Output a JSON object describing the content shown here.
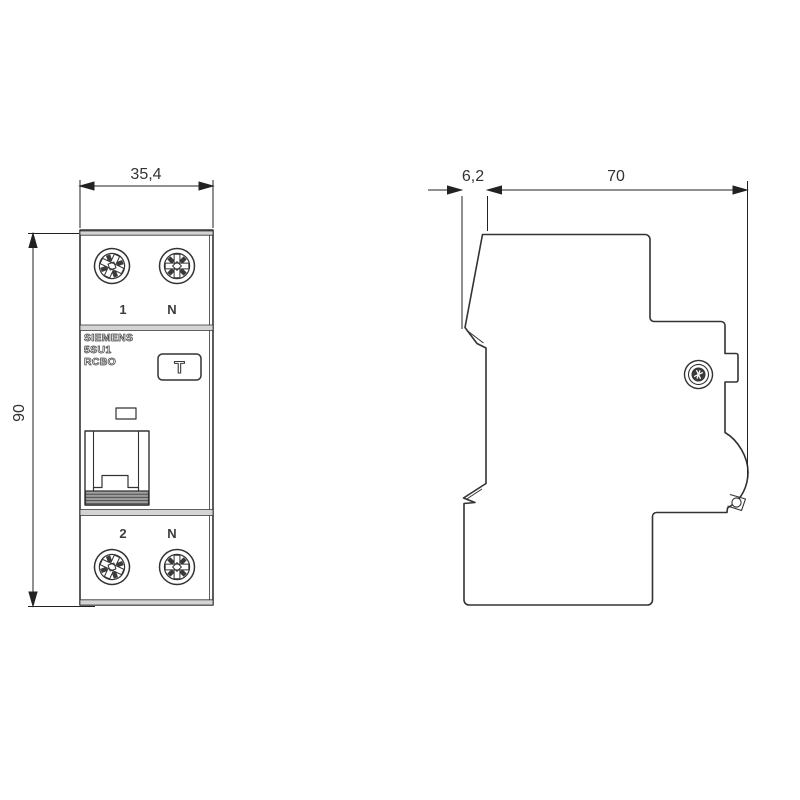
{
  "drawing": {
    "title": "circuit-breaker-dimension-drawing",
    "dimensions": {
      "front_width_mm": "35,4",
      "front_height_mm": "90",
      "side_front_depth_mm": "6,2",
      "side_depth_mm": "70"
    },
    "front": {
      "terminals_top": [
        "1",
        "N"
      ],
      "terminals_bottom": [
        "2",
        "N"
      ],
      "product_lines": [
        "SIEMENS",
        "5SU1",
        "RCBO"
      ],
      "test_button_label": "T"
    },
    "colors": {
      "line": "#333333",
      "band_fill": "#d4d4d4",
      "grip_fill": "#9e9e9e",
      "background": "#ffffff"
    }
  }
}
